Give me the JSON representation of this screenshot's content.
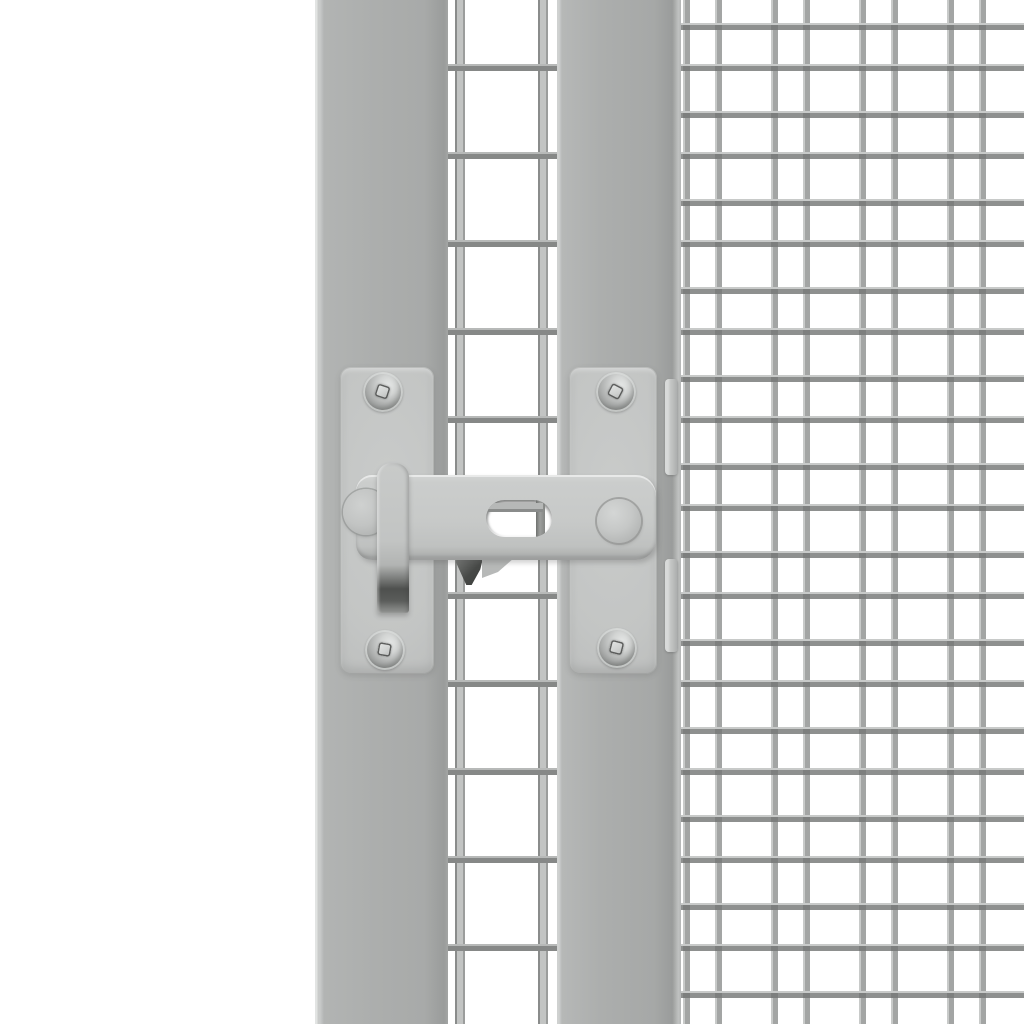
{
  "scene": {
    "subject": "Close-up product photo of a gray steel gate latch mounted on a wire-mesh gate",
    "components": [
      "left frame post",
      "middle welded-mesh gap",
      "right frame post",
      "right welded-mesh panel",
      "latch left mounting plate",
      "latch right mounting plate",
      "swing arm with adjustment slot",
      "fold-down handle with dark grip",
      "left pivot knob",
      "right guide knob",
      "four pan-head screws with square drive",
      "two catch tabs",
      "dark catch wedge"
    ]
  },
  "palette": {
    "background": "#ffffff",
    "bar": "#acaead",
    "bar-light": "#c9cbca",
    "bar-dark": "#9a9c9b",
    "bar-edge": "#e2e4e3",
    "plate": "#c3c5c4",
    "arm": "#c7c9c8",
    "arm-top": "#d3d5d4",
    "strip": "#c2c4c3",
    "grip-dark": "#4e504e",
    "grip-mid": "#7b7d7b",
    "knob": "#c6c8c7",
    "wire": "#a3a5a4",
    "wire-dark": "#8e908f",
    "wire-light": "#c8cac9",
    "wire-joint": "#7d7f7e",
    "gap-wire-body": "#c2c4c3",
    "gap-wire-edge": "#8a8c8b",
    "screw-light": "#e4e6e5",
    "screw-mid": "#b2b4b3",
    "screw-dark": "#888a89",
    "wedge-dark": "#474947",
    "wedge-light": "#b7b9b8"
  }
}
